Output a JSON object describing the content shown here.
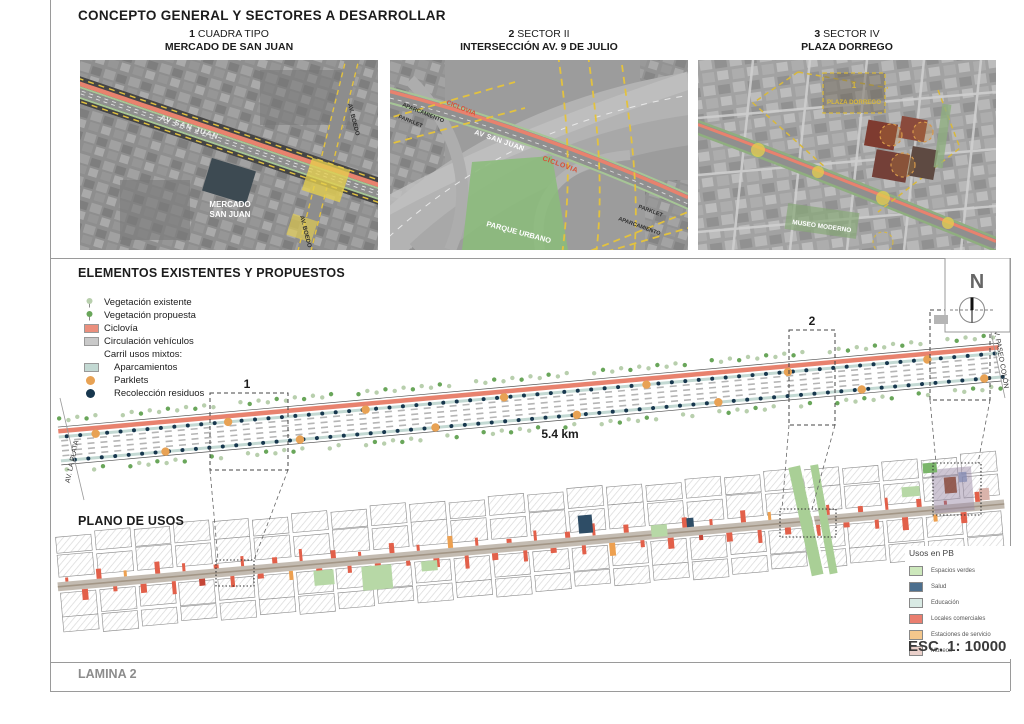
{
  "header": {
    "title": "CONCEPTO GENERAL Y SECTORES A DESARROLLAR"
  },
  "sectors": [
    {
      "num": "1",
      "name": "CUADRA TIPO",
      "place": "MERCADO DE SAN JUAN"
    },
    {
      "num": "2",
      "name": "SECTOR II",
      "place": "INTERSECCIÓN AV. 9 DE JULIO"
    },
    {
      "num": "3",
      "name": "SECTOR IV",
      "place": "PLAZA DORREGO"
    }
  ],
  "map1": {
    "av": "AV SAN JUAN",
    "boedo_top": "AV. BOEDO",
    "boedo_bottom": "AV. BOEDO",
    "mercado1": "MERCADO",
    "mercado2": "SAN JUAN"
  },
  "map2": {
    "aparcamiento_tl": "APARCAMIENTO",
    "ciclovia_tl": "CICLOVIA",
    "parklet_tl": "PARKLET",
    "av": "AV SAN JUAN",
    "ciclovia_mid": "CICLOVIA",
    "parque": "PARQUE URBANO",
    "parklet_br": "PARKLET",
    "aparcamiento_br": "APARCAMIENTO"
  },
  "map3": {
    "num": "1",
    "plaza": "PLAZA DORREGO",
    "museo": "MUSEO MODERNO"
  },
  "elements": {
    "title": "ELEMENTOS EXISTENTES Y PROPUESTOS",
    "legend": [
      {
        "label": "Vegetación existente",
        "icon": "tree",
        "color": "#b8cfad",
        "indent": false
      },
      {
        "label": "Vegetación propuesta",
        "icon": "tree",
        "color": "#69a65a",
        "indent": false
      },
      {
        "label": "Ciclovía",
        "icon": "swatch",
        "color": "#eb8f7d",
        "indent": false
      },
      {
        "label": "Circulación vehículos",
        "icon": "swatch",
        "color": "#c9c9c9",
        "indent": false
      },
      {
        "label": "Carril usos mixtos:",
        "icon": "none",
        "color": "",
        "indent": false
      },
      {
        "label": "Aparcamientos",
        "icon": "swatch",
        "color": "#c3d9d3",
        "indent": true
      },
      {
        "label": "Parklets",
        "icon": "dot",
        "color": "#e8a254",
        "indent": true
      },
      {
        "label": "Recolección residuos",
        "icon": "dot",
        "color": "#17374e",
        "indent": true
      }
    ],
    "marker1": "1",
    "marker2": "2",
    "marker3": "3",
    "distance": "5.4 km",
    "av_left": "AV. LA PLATA",
    "av_right": "AV. PASEO COLÓN",
    "north": "N"
  },
  "plano": {
    "title": "PLANO DE USOS",
    "usos_title": "Usos en PB",
    "usos": [
      {
        "label": "Espacios verdes",
        "color": "#cde8bc"
      },
      {
        "label": "Salud",
        "color": "#4c6f8e"
      },
      {
        "label": "Educación",
        "color": "#d9eae4"
      },
      {
        "label": "Locales comerciales",
        "color": "#ea7e6f"
      },
      {
        "label": "Estaciones de servicio",
        "color": "#f4c78c"
      },
      {
        "label": "Museos",
        "color": "#ead0ca"
      }
    ],
    "scale": "ESC. 1: 10000"
  },
  "footer": {
    "label": "LAMINA 2"
  }
}
